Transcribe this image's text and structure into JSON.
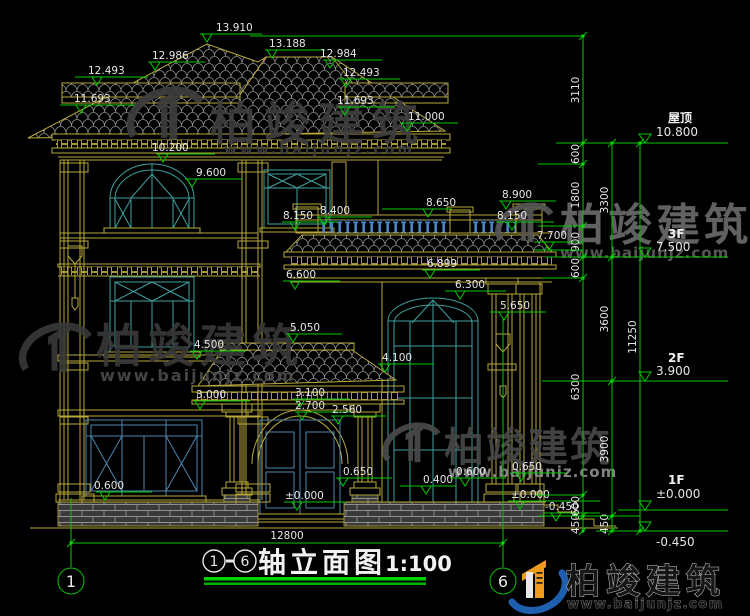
{
  "drawing": {
    "kind": "house front elevation, CAD style",
    "width_px": 750,
    "height_px": 616
  },
  "colors": {
    "background": "#000000",
    "linework": "#b9a93c",
    "window": "#3fa0a0",
    "door_window": "#4e86b0",
    "dimension": "#00c800",
    "underline_green": "#00d400",
    "text": "#e6e6e6",
    "tile": "#8f8f8f",
    "brick": "#909090",
    "watermark_dark": "#3d3d3d",
    "watermark_light": "#6a6a6a",
    "logo_blue": "#1f5fb0",
    "logo_orange": "#f09a1e"
  },
  "elevation_markers": [
    {
      "v": "13.910",
      "ax": 207,
      "ay": 42,
      "x1": 200,
      "x2": 262,
      "tx": 216
    },
    {
      "v": "12.986",
      "ax": 155,
      "ay": 70,
      "x1": 148,
      "x2": 205,
      "tx": 152
    },
    {
      "v": "13.188",
      "ax": 272,
      "ay": 58,
      "x1": 265,
      "x2": 325,
      "tx": 269
    },
    {
      "v": "12.984",
      "ax": 330,
      "ay": 68,
      "x1": 323,
      "x2": 382,
      "tx": 320
    },
    {
      "v": "12.493",
      "ax": 97,
      "ay": 85,
      "x1": 75,
      "x2": 148,
      "tx": 88
    },
    {
      "v": "12.493",
      "ax": 346,
      "ay": 87,
      "x1": 339,
      "x2": 400,
      "tx": 343
    },
    {
      "v": "11.693",
      "ax": 81,
      "ay": 113,
      "x1": 60,
      "x2": 135,
      "tx": 74
    },
    {
      "v": "11.693",
      "ax": 345,
      "ay": 115,
      "x1": 338,
      "x2": 395,
      "tx": 337
    },
    {
      "v": "11.000",
      "ax": 407,
      "ay": 131,
      "x1": 400,
      "x2": 458,
      "tx": 408
    },
    {
      "v": "10.200",
      "ax": 163,
      "ay": 162,
      "x1": 156,
      "x2": 215,
      "tx": 152
    },
    {
      "v": "9.600",
      "ax": 192,
      "ay": 187,
      "x1": 185,
      "x2": 242,
      "tx": 196
    },
    {
      "v": "8.400",
      "ax": 324,
      "ay": 225,
      "x1": 317,
      "x2": 372,
      "tx": 320
    },
    {
      "v": "8.650",
      "ax": 428,
      "ay": 217,
      "x1": 382,
      "x2": 452,
      "tx": 426
    },
    {
      "v": "8.900",
      "ax": 506,
      "ay": 209,
      "x1": 499,
      "x2": 556,
      "tx": 502
    },
    {
      "v": "8.150",
      "ax": 295,
      "ay": 230,
      "x1": 282,
      "x2": 338,
      "tx": 283
    },
    {
      "v": "8.150",
      "ax": 512,
      "ay": 230,
      "x1": 496,
      "x2": 554,
      "tx": 497
    },
    {
      "v": "7.700",
      "ax": 549,
      "ay": 250,
      "x1": 534,
      "x2": 582,
      "tx": 537
    },
    {
      "v": "6.600",
      "ax": 295,
      "ay": 289,
      "x1": 283,
      "x2": 340,
      "tx": 286
    },
    {
      "v": "6.899",
      "ax": 430,
      "ay": 278,
      "x1": 422,
      "x2": 480,
      "tx": 427
    },
    {
      "v": "6.300",
      "ax": 460,
      "ay": 299,
      "x1": 445,
      "x2": 506,
      "tx": 455
    },
    {
      "v": "5.650",
      "ax": 504,
      "ay": 320,
      "x1": 490,
      "x2": 546,
      "tx": 500
    },
    {
      "v": "5.050",
      "ax": 293,
      "ay": 342,
      "x1": 286,
      "x2": 342,
      "tx": 290
    },
    {
      "v": "4.500",
      "ax": 197,
      "ay": 359,
      "x1": 190,
      "x2": 246,
      "tx": 194
    },
    {
      "v": "4.100",
      "ax": 385,
      "ay": 372,
      "x1": 378,
      "x2": 434,
      "tx": 382
    },
    {
      "v": "3.000",
      "ax": 200,
      "ay": 409,
      "x1": 193,
      "x2": 250,
      "tx": 196
    },
    {
      "v": "3.100",
      "ax": 300,
      "ay": 407,
      "x1": 293,
      "x2": 350,
      "tx": 295
    },
    {
      "v": "2.700",
      "ax": 302,
      "ay": 420,
      "x1": 295,
      "x2": 352,
      "tx": 295
    },
    {
      "v": "2.560",
      "ax": 338,
      "ay": 424,
      "x1": 331,
      "x2": 386,
      "tx": 332
    },
    {
      "v": "0.600",
      "ax": 105,
      "ay": 500,
      "x1": 96,
      "x2": 152,
      "tx": 94
    },
    {
      "v": "0.650",
      "ax": 343,
      "ay": 486,
      "x1": 336,
      "x2": 392,
      "tx": 343
    },
    {
      "v": "0.400",
      "ax": 426,
      "ay": 494,
      "x1": 400,
      "x2": 456,
      "tx": 423
    },
    {
      "v": "0.600",
      "ax": 465,
      "ay": 486,
      "x1": 450,
      "x2": 506,
      "tx": 456
    },
    {
      "v": "0.650",
      "ax": 521,
      "ay": 481,
      "x1": 510,
      "x2": 566,
      "tx": 512
    },
    {
      "v": "±0.000",
      "ax": 297,
      "ay": 510,
      "x1": 284,
      "x2": 346,
      "tx": 285
    },
    {
      "v": "±0.000",
      "ax": 520,
      "ay": 509,
      "x1": 508,
      "x2": 600,
      "tx": 511
    },
    {
      "v": "-0.450",
      "ax": 556,
      "ay": 521,
      "x1": 543,
      "x2": 600,
      "tx": 545
    }
  ],
  "floor_flags": [
    {
      "name": "屋顶",
      "value": "10.800",
      "y": 143,
      "ny": 122,
      "vy": 136
    },
    {
      "name": "3F",
      "value": "7.500",
      "y": 257,
      "ny": 238,
      "vy": 251
    },
    {
      "name": "2F",
      "value": "3.900",
      "y": 381,
      "ny": 362,
      "vy": 375
    },
    {
      "name": "1F",
      "value": "±0.000",
      "y": 510,
      "ny": 484,
      "vy": 498
    },
    {
      "name": "",
      "value": "-0.450",
      "y": 531,
      "ny": 0,
      "vy": 546
    }
  ],
  "dim_chains": [
    {
      "x": 583,
      "ticks": [
        36,
        143,
        164,
        226,
        257,
        278,
        495,
        516,
        531
      ],
      "labels": [
        {
          "t": "3110",
          "y": 90
        },
        {
          "t": "600",
          "y": 154
        },
        {
          "t": "1800",
          "y": 195
        },
        {
          "t": "900",
          "y": 242
        },
        {
          "t": "600",
          "y": 268
        },
        {
          "t": "6300",
          "y": 387
        },
        {
          "t": "600",
          "y": 506
        },
        {
          "t": "450",
          "y": 524
        }
      ]
    },
    {
      "x": 612,
      "ticks": [
        143,
        257,
        381,
        516,
        531
      ],
      "labels": [
        {
          "t": "3300",
          "y": 200
        },
        {
          "t": "3600",
          "y": 319
        },
        {
          "t": "3900",
          "y": 449
        },
        {
          "t": "450",
          "y": 524
        }
      ]
    },
    {
      "x": 640,
      "ticks": [
        143,
        531
      ],
      "labels": [
        {
          "t": "11250",
          "y": 337
        }
      ]
    }
  ],
  "ext_lines": [
    [
      250,
      36,
      583
    ],
    [
      556,
      143,
      640
    ],
    [
      538,
      164,
      583
    ],
    [
      538,
      226,
      583
    ],
    [
      534,
      250,
      583
    ],
    [
      545,
      257,
      640
    ],
    [
      542,
      278,
      583
    ],
    [
      542,
      381,
      640
    ],
    [
      536,
      495,
      583
    ],
    [
      538,
      516,
      640
    ],
    [
      596,
      531,
      640
    ]
  ],
  "axis": {
    "left_bubble": "1",
    "right_bubble": "6",
    "total_width": "12800"
  },
  "title": {
    "c1": "1",
    "c2": "6",
    "dash": "-",
    "text": "轴立面图",
    "scale": "1:100"
  },
  "watermarks": [
    {
      "text": "柏竣建筑",
      "url": "www.baijunjz.com",
      "text_x": 210,
      "text_y": 140,
      "text_size": 46,
      "spacing": 8,
      "text_color": "#3d3d3d",
      "url_x": 224,
      "url_y": 154,
      "url_size": 14,
      "url_spacing": 3,
      "url_color": "#3f3f3f",
      "logo_cx": 170,
      "logo_cy": 118,
      "logo_r": 36,
      "logo_color": "#3d3d3d"
    },
    {
      "text": "柏竣建筑",
      "url": "www.baijunjz.com",
      "text_x": 96,
      "text_y": 362,
      "text_size": 46,
      "spacing": 6,
      "text_color": "#383838",
      "url_x": 100,
      "url_y": 381,
      "url_size": 16,
      "url_spacing": 2,
      "url_color": "#4a4a4a",
      "logo_cx": 60,
      "logo_cy": 352,
      "logo_r": 34,
      "logo_color": "#383838"
    },
    {
      "text": "柏竣建筑",
      "url": "www.baijunjz.com",
      "text_x": 560,
      "text_y": 240,
      "text_size": 44,
      "spacing": 4,
      "text_color": "#6a6a6a",
      "url_x": 560,
      "url_y": 258,
      "url_size": 15,
      "url_spacing": 1,
      "url_color": "#5e5e5e",
      "logo_cx": 528,
      "logo_cy": 226,
      "logo_r": 27,
      "logo_color": "#555555"
    },
    {
      "text": "柏竣建筑",
      "url": "www.baijunjz.com",
      "text_x": 444,
      "text_y": 461,
      "text_size": 40,
      "spacing": 2,
      "text_color": "#474747",
      "url_x": 448,
      "url_y": 477,
      "url_size": 15,
      "url_spacing": 1,
      "url_color": "#8f8f8f",
      "logo_cx": 415,
      "logo_cy": 446,
      "logo_r": 27,
      "logo_color": "#4a4a4a"
    }
  ],
  "brand": {
    "name": "柏竣建筑",
    "url": "www.baijunjz.com"
  }
}
